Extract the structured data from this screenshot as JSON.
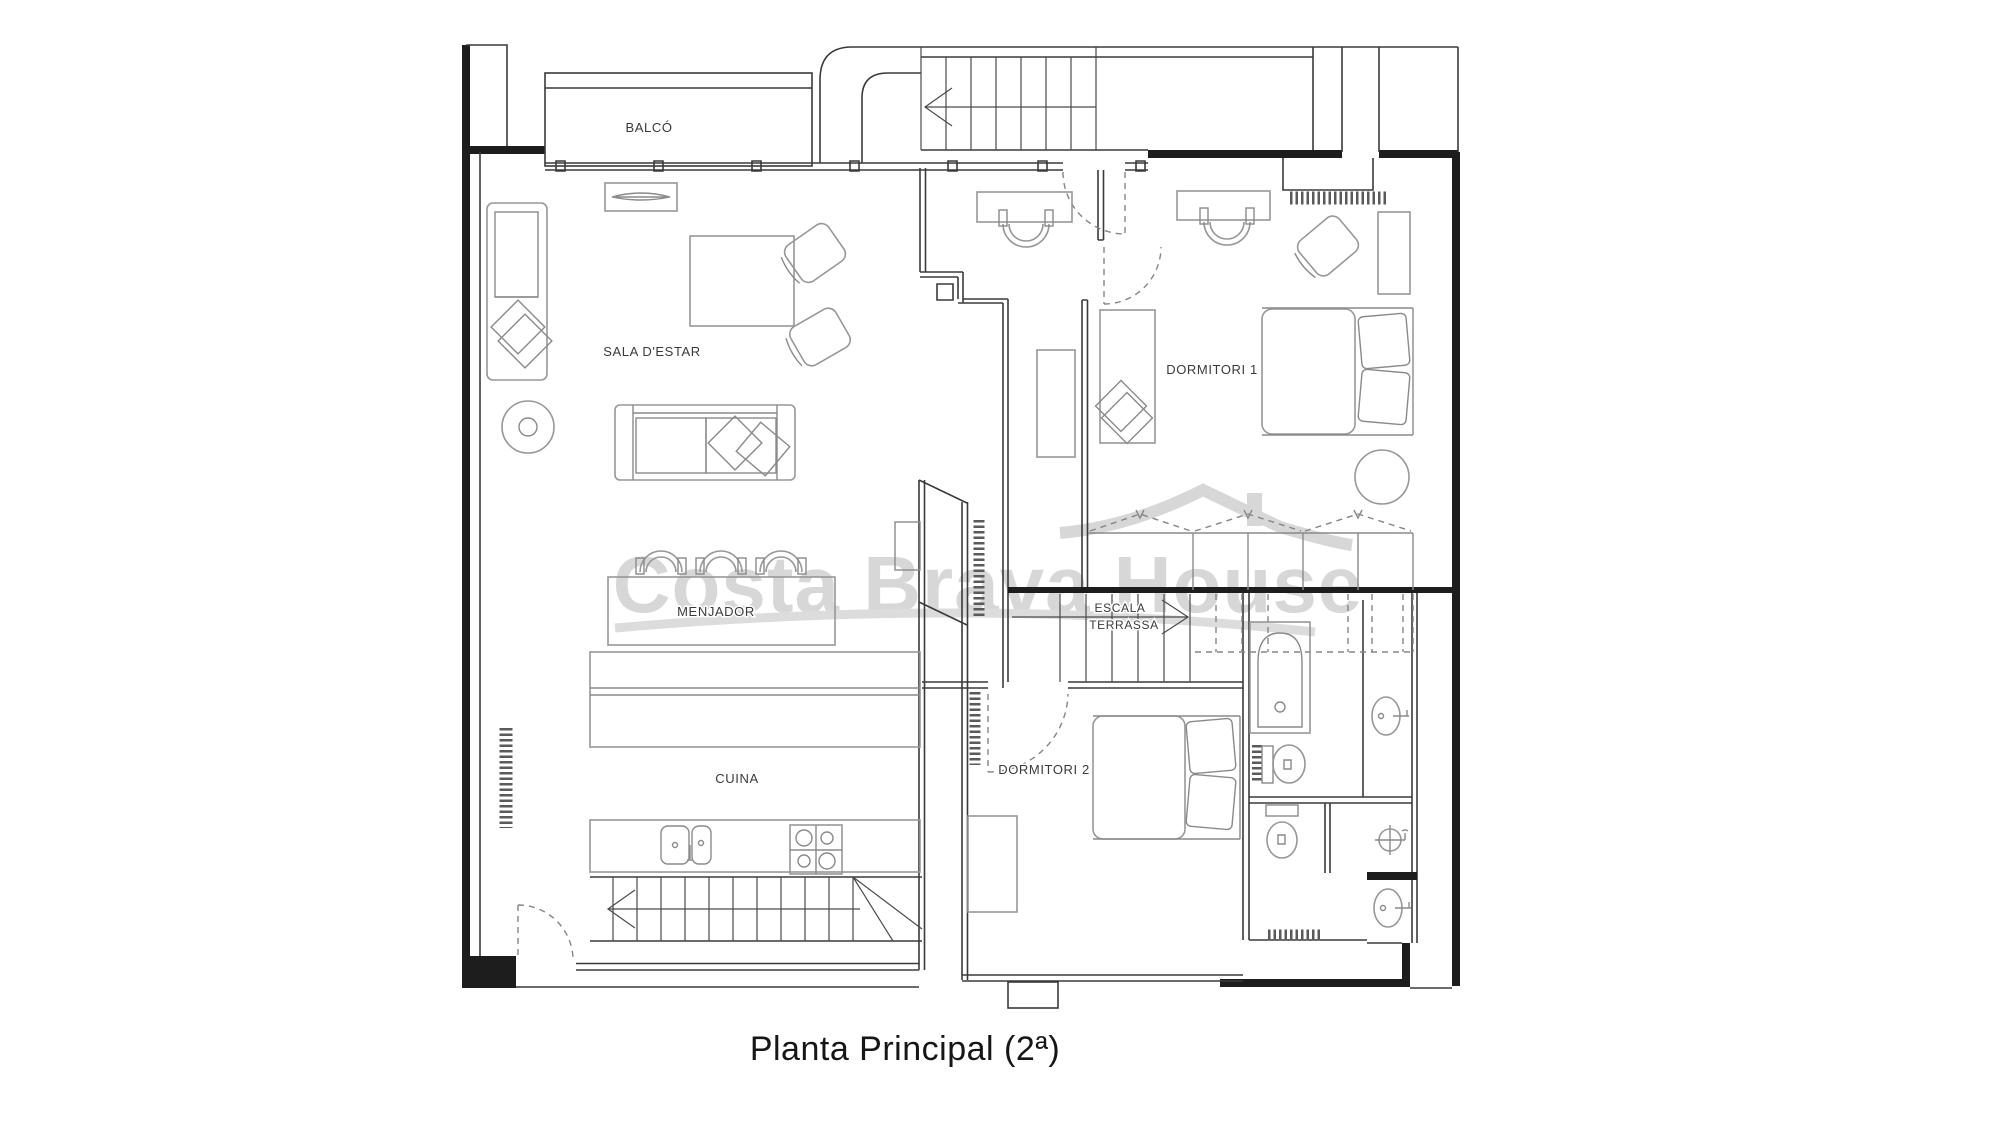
{
  "title": "Planta Principal (2ª)",
  "watermark": {
    "text": "Costa Brava House"
  },
  "labels": {
    "balco": "BALCÓ",
    "sala": "SALA D'ESTAR",
    "menjador": "MENJADOR",
    "cuina": "CUINA",
    "dormitori1": "DORMITORI 1",
    "dormitori2": "DORMITORI 2",
    "escala_line1": "ESCALA",
    "escala_line2": "TERRASSA"
  },
  "colors": {
    "background": "#ffffff",
    "wall": "#1d1d1d",
    "partition": "#3a3a3a",
    "furniture": "#979797",
    "label": "#3a3a3a",
    "watermark": "#d7d7d7",
    "title": "#161616"
  }
}
